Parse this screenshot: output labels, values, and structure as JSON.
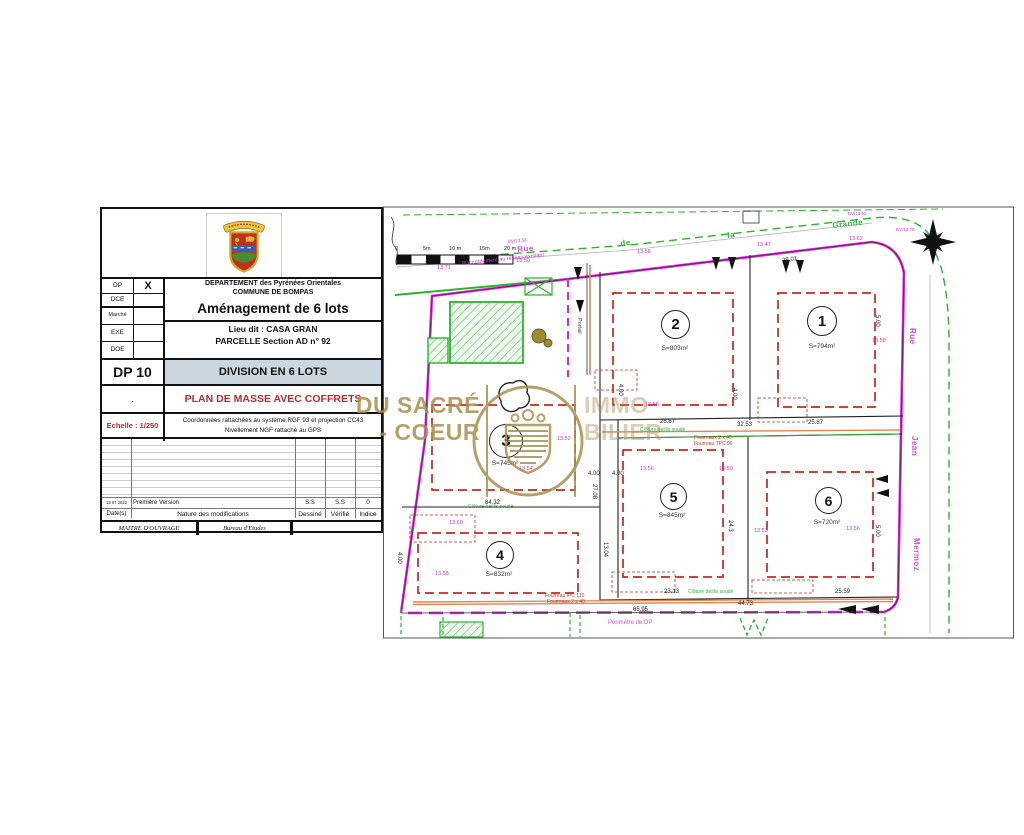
{
  "title_block": {
    "admin_rows": {
      "dp_label": "DP",
      "dp_value": "X",
      "dce_label": "DCE",
      "marche_label": "Marché",
      "exe_label": "EXE",
      "doe_label": "DOE"
    },
    "department_line1": "DEPARTEMENT des Pyrénées Orientales",
    "department_line2": "COMMUNE DE BOMPAS",
    "project_title": "Aménagement de 6 lots",
    "lieu_dit": "Lieu dit : CASA GRAN",
    "parcelle": "PARCELLE Section AD n° 92",
    "doc_code": "DP 10",
    "doc_title": "DIVISION EN 6 LOTS",
    "plan_title": "PLAN DE MASSE AVEC COFFRETS",
    "dot": ".",
    "scale_label": "Echelle : 1/250",
    "coords_line1": "Coordonnées rattachées au système RGF 93 et projection CC43",
    "coords_line2": "Nivellement NGF rattaché au GPS",
    "revision": {
      "date": "13 07 2022",
      "description": "Première Version",
      "drawn": "S.S",
      "checked": "S.S",
      "index": "0"
    },
    "table_headers": {
      "date": "Date(s)",
      "nature": "Nature des modifications",
      "drawn": "Dessiné",
      "checked": "Vérifié",
      "index": "Indice"
    },
    "footer": {
      "maitre": "MAITRE D'OUVRAGE",
      "bureau": "Bureau d'Etudes"
    }
  },
  "watermark": {
    "line1": "DU SACRÉ",
    "line2": "- COEUR",
    "line3": "IMMO",
    "line4": "BILIER"
  },
  "plan": {
    "lots": [
      {
        "number": "1",
        "area": "S=794m²"
      },
      {
        "number": "2",
        "area": "S=803m²"
      },
      {
        "number": "3",
        "area": "S=745m²"
      },
      {
        "number": "4",
        "area": "S=832m²"
      },
      {
        "number": "5",
        "area": "S=845m²"
      },
      {
        "number": "6",
        "area": "S=720m²"
      }
    ],
    "scale_bar_labels": [
      {
        "t": "0",
        "x": 395,
        "y": 247
      },
      {
        "t": "5m",
        "x": 423,
        "y": 247
      },
      {
        "t": "10 m",
        "x": 449,
        "y": 247
      },
      {
        "t": "15m",
        "x": 479,
        "y": 247
      },
      {
        "t": "20 m",
        "x": 504,
        "y": 247
      }
    ],
    "street_labels": [
      {
        "t": "Rue",
        "x": 517,
        "y": 246,
        "r": -5,
        "c": "#d24fd2",
        "fs": 8
      },
      {
        "t": "de",
        "x": 620,
        "y": 240,
        "r": -6,
        "c": "#35b04a",
        "fs": 8
      },
      {
        "t": "la",
        "x": 727,
        "y": 232,
        "r": -6,
        "c": "#35b04a",
        "fs": 8
      },
      {
        "t": "Grande",
        "x": 832,
        "y": 222,
        "r": -6,
        "c": "#35b04a",
        "fs": 8
      },
      {
        "t": "Rue",
        "x": 916,
        "y": 328,
        "r": 90,
        "c": "#d24fd2",
        "fs": 8
      },
      {
        "t": "Jean",
        "x": 918,
        "y": 436,
        "r": 90,
        "c": "#d24fd2",
        "fs": 8
      },
      {
        "t": "Mermoz",
        "x": 920,
        "y": 538,
        "r": 90,
        "c": "#d24fd2",
        "fs": 8
      }
    ],
    "annotations": [
      {
        "t": "Raccordement au réseau existant",
        "x": 462,
        "y": 262,
        "r": -6,
        "c": "#cc33cc",
        "fs": 5.5
      },
      {
        "t": "Portail",
        "x": 581,
        "y": 318,
        "r": 90,
        "c": "#444444",
        "fs": 5.5
      },
      {
        "t": "Fourreaux 2 x 40",
        "x": 694,
        "y": 436,
        "c": "#c0392b",
        "fs": 5
      },
      {
        "t": "Fourreau TPC 90",
        "x": 694,
        "y": 442,
        "c": "#c0392b",
        "fs": 5
      },
      {
        "t": "Fourreau IPC 110",
        "x": 545,
        "y": 594,
        "c": "#c0392b",
        "fs": 5
      },
      {
        "t": "Fourreaux 2 x 40",
        "x": 547,
        "y": 600,
        "c": "#c0392b",
        "fs": 5
      },
      {
        "t": "Périmètre de DP",
        "x": 608,
        "y": 620,
        "c": "#d24fd2",
        "fs": 6
      },
      {
        "t": "Clôture treillis soudé",
        "x": 640,
        "y": 428,
        "c": "#35b04a",
        "fs": 5
      },
      {
        "t": "Clôture treillis soudé",
        "x": 468,
        "y": 505,
        "c": "#35b04a",
        "fs": 5
      },
      {
        "t": "Clôture treillis soudé",
        "x": 688,
        "y": 590,
        "c": "#35b04a",
        "fs": 5
      },
      {
        "t": "BV/13.58",
        "x": 508,
        "y": 240,
        "r": -5,
        "c": "#cc33cc",
        "fs": 4.5
      },
      {
        "t": "BV/13.62",
        "x": 848,
        "y": 212,
        "c": "#cc33cc",
        "fs": 4.5
      },
      {
        "t": "BV/13.79",
        "x": 896,
        "y": 228,
        "c": "#cc33cc",
        "fs": 4.5
      }
    ],
    "dimensions": [
      {
        "t": "28.01",
        "x": 782,
        "y": 258,
        "r": -7
      },
      {
        "t": "26.67",
        "x": 660,
        "y": 419
      },
      {
        "t": "32.53",
        "x": 737,
        "y": 422
      },
      {
        "t": "25.87",
        "x": 808,
        "y": 420
      },
      {
        "t": "84.32",
        "x": 485,
        "y": 500
      },
      {
        "t": "27.08",
        "x": 597,
        "y": 484,
        "r": 90
      },
      {
        "t": "13.04",
        "x": 608,
        "y": 542,
        "r": 90
      },
      {
        "t": "4.00",
        "x": 737,
        "y": 388,
        "r": 90
      },
      {
        "t": "4.00",
        "x": 623,
        "y": 384,
        "r": 90
      },
      {
        "t": "4.00",
        "x": 588,
        "y": 471
      },
      {
        "t": "4.00",
        "x": 612,
        "y": 471
      },
      {
        "t": "4.00",
        "x": 402,
        "y": 552,
        "r": 90
      },
      {
        "t": "5.00",
        "x": 880,
        "y": 315,
        "r": 90
      },
      {
        "t": "5.00",
        "x": 880,
        "y": 525,
        "r": 90
      },
      {
        "t": "23.13",
        "x": 664,
        "y": 589
      },
      {
        "t": "25.59",
        "x": 835,
        "y": 589
      },
      {
        "t": "44.73",
        "x": 738,
        "y": 601
      },
      {
        "t": "65.95",
        "x": 633,
        "y": 607
      },
      {
        "t": "24.3",
        "x": 733,
        "y": 520,
        "r": 90
      }
    ],
    "elevations": [
      {
        "t": "13.71",
        "x": 437,
        "y": 266
      },
      {
        "t": "13.50",
        "x": 516,
        "y": 259
      },
      {
        "t": "13.58",
        "x": 637,
        "y": 250
      },
      {
        "t": "13.47",
        "x": 757,
        "y": 243
      },
      {
        "t": "13.62",
        "x": 849,
        "y": 237
      },
      {
        "t": "13.55",
        "x": 645,
        "y": 403
      },
      {
        "t": "13.58",
        "x": 872,
        "y": 339
      },
      {
        "t": "13.56",
        "x": 640,
        "y": 467
      },
      {
        "t": "13.50",
        "x": 719,
        "y": 467
      },
      {
        "t": "13.53",
        "x": 754,
        "y": 529
      },
      {
        "t": "13.56",
        "x": 846,
        "y": 527
      },
      {
        "t": "13.60",
        "x": 449,
        "y": 521
      },
      {
        "t": "13.55",
        "x": 435,
        "y": 572
      },
      {
        "t": "13.54",
        "x": 519,
        "y": 467
      },
      {
        "t": "13.52",
        "x": 557,
        "y": 437
      }
    ]
  }
}
